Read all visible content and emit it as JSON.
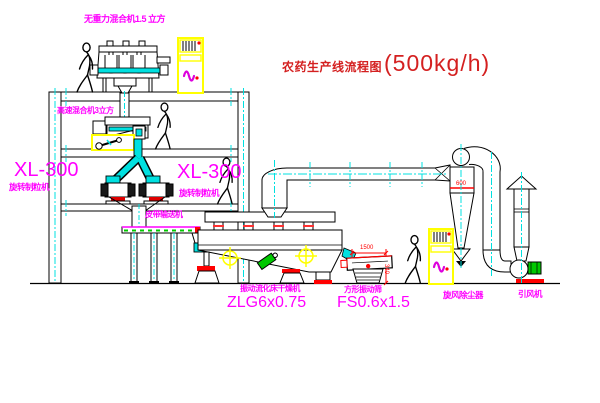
{
  "title": {
    "name_cn": "农药生产线流程图",
    "capacity": "(500kg/h)"
  },
  "labels": {
    "weightless_mixer": "无重力混合机1.5 立方",
    "high_speed_mixer": "高速混合机3立方",
    "granulator_left_model": "XL-300",
    "granulator_left_name": "旋转制粒机",
    "granulator_mid_model": "XL-300",
    "granulator_mid_name": "旋转制粒机",
    "belt_conveyor": "皮带输送机",
    "fluid_bed_dryer_name": "振动流化床干燥机",
    "fluid_bed_dryer_model": "ZLG6x0.75",
    "square_sieve_name": "方形振动筛",
    "square_sieve_model": "FS0.6x1.5",
    "cyclone_name": "旋风除尘器",
    "induced_draft_fan_name": "引风机"
  },
  "dimensions": {
    "cyclone_width": "600",
    "sieve_length": "1500",
    "sieve_height": "340"
  },
  "colors": {
    "background": "#ffffff",
    "line_black": "#000000",
    "centerline_cyan": "#00e0e0",
    "label_magenta": "#ff00ff",
    "title_red": "#d42020",
    "dimension_red": "#ff0000",
    "cabinet_yellow": "#ffff00",
    "machine_green": "#00c800"
  }
}
